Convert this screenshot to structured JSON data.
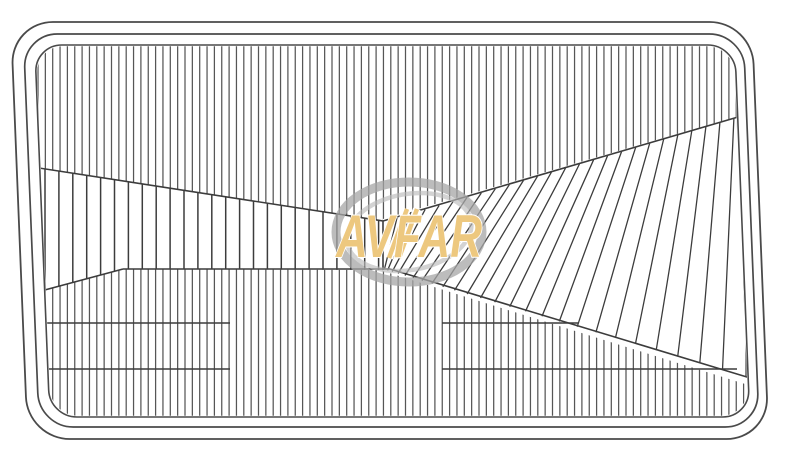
{
  "meta": {
    "description": "Technical line drawing of a headlamp lens glass with brand logo",
    "background": "#ffffff"
  },
  "logo": {
    "text": "AVFAR",
    "text_color": "#edc87f",
    "text_outline": "#ffffff",
    "swoosh_color": "#a6a6a6",
    "swoosh_inner_color": "#bcbcbc",
    "slash_color": "#edc87f"
  },
  "drawing": {
    "canvas": {
      "width": 800,
      "height": 467
    },
    "colors": {
      "frame": "#4a4a4a",
      "dense": "#565656",
      "detail": "#3c3c3c"
    },
    "skew_deg": 2.3,
    "frames": [
      {
        "x": 10,
        "y": 22,
        "w": 741,
        "h": 417,
        "rx": 42,
        "sw": 1.8
      },
      {
        "x": 22,
        "y": 34,
        "w": 720,
        "h": 393,
        "rx": 34,
        "sw": 1.7
      },
      {
        "x": 33,
        "y": 45,
        "w": 700,
        "h": 372,
        "rx": 27,
        "sw": 1.6
      }
    ],
    "dense": {
      "x0": 38,
      "x1": 752,
      "step": 7.35,
      "y0": 44,
      "y1": 416.5,
      "sw": 1.25
    },
    "band": {
      "poly": [
        [
          26,
          166
        ],
        [
          383,
          221
        ],
        [
          383,
          270
        ],
        [
          123,
          269
        ],
        [
          26,
          295
        ]
      ],
      "x0": 45,
      "step": 13.9,
      "ytop": 150,
      "ybot": 308,
      "sw": 1.5
    },
    "wedge": {
      "poly": [
        [
          383,
          219
        ],
        [
          774,
          106
        ],
        [
          774,
          393
        ],
        [
          383,
          271
        ]
      ],
      "top": [
        [
          383,
          222
        ],
        [
          762,
          110
        ]
      ],
      "bottom": [
        [
          383,
          269
        ],
        [
          770,
          384
        ]
      ],
      "n": 27,
      "exp": 1.7,
      "sw": 1.3
    },
    "boundaries": [
      [
        [
          26,
          166
        ],
        [
          383,
          221
        ]
      ],
      [
        [
          383,
          221
        ],
        [
          762,
          110
        ]
      ],
      [
        [
          383,
          221
        ],
        [
          383,
          270
        ]
      ],
      [
        [
          26,
          295
        ],
        [
          123,
          269
        ]
      ],
      [
        [
          123,
          269
        ],
        [
          390,
          269
        ]
      ],
      [
        [
          390,
          269
        ],
        [
          770,
          384
        ]
      ]
    ],
    "block_lines": [
      [
        [
          38,
          323
        ],
        [
          230,
          323
        ]
      ],
      [
        [
          442,
          323
        ],
        [
          578,
          323
        ]
      ],
      [
        [
          38,
          369
        ],
        [
          230,
          369
        ]
      ],
      [
        [
          442,
          369
        ],
        [
          737,
          369
        ]
      ]
    ],
    "logo_geo": {
      "cx": 409,
      "cy": 232,
      "rx1": 73,
      "ry1": 50,
      "sw1": 9,
      "rx2": 63,
      "ry2": 38,
      "rot2": -10,
      "sw2": 4.5,
      "text_x": 336,
      "text_y": 257,
      "font_size": 60,
      "text_length": 146,
      "slashes": [
        [
          [
            389,
            258
          ],
          [
            407,
            209
          ]
        ],
        [
          [
            399,
            258
          ],
          [
            417,
            209
          ]
        ]
      ]
    }
  }
}
